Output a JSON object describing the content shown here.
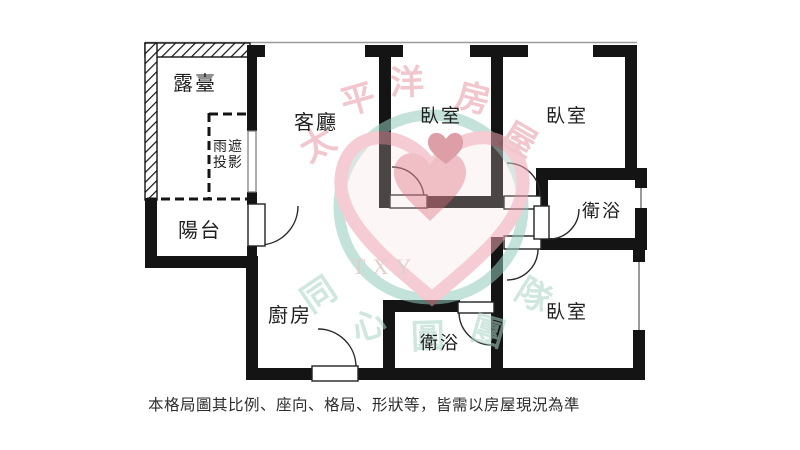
{
  "page": {
    "background": "#ffffff"
  },
  "disclaimer": "本格局圖其比例、座向、格局、形狀等，皆需以房屋現況為準",
  "rooms": {
    "terrace": "露臺",
    "rain_shade_line1": "雨遮",
    "rain_shade_line2": "投影",
    "balcony": "陽台",
    "living": "客廳",
    "bedroom_top_mid": "臥室",
    "bedroom_top_right": "臥室",
    "bath_right": "衛浴",
    "kitchen": "廚房",
    "bath_bottom": "衛浴",
    "bedroom_bottom_right": "臥室"
  },
  "watermark": {
    "logo_text": "TXY",
    "brand_top": [
      "太",
      "平",
      "洋",
      "房",
      "屋"
    ],
    "brand_bottom": [
      "同",
      "心",
      "圓",
      "團",
      "隊"
    ],
    "colors": {
      "pink_char": "#e798a4",
      "green_char": "#a9d4c6",
      "circle": "#93cbbc",
      "heart_outline": "#eda4b0",
      "heart_fill": "#f7dadd",
      "heart_mid": "#e48b98",
      "heart_dark": "#c24f61",
      "txy": "#c8a79e",
      "wall": "#141414"
    }
  }
}
